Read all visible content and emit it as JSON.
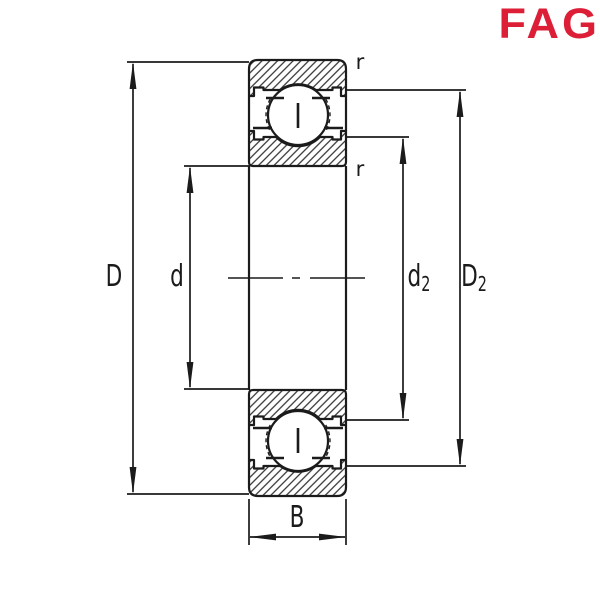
{
  "logo": {
    "text": "FAG"
  },
  "colors": {
    "logo_red": "#DC1E37",
    "line": "#1b1b1b",
    "background": "#ffffff"
  },
  "labels": {
    "D": "D",
    "d": "d",
    "d2": {
      "base": "d",
      "sub": "2"
    },
    "D2": {
      "base": "D",
      "sub": "2"
    },
    "B": "B",
    "r_outer": "r",
    "r_inner": "r"
  }
}
